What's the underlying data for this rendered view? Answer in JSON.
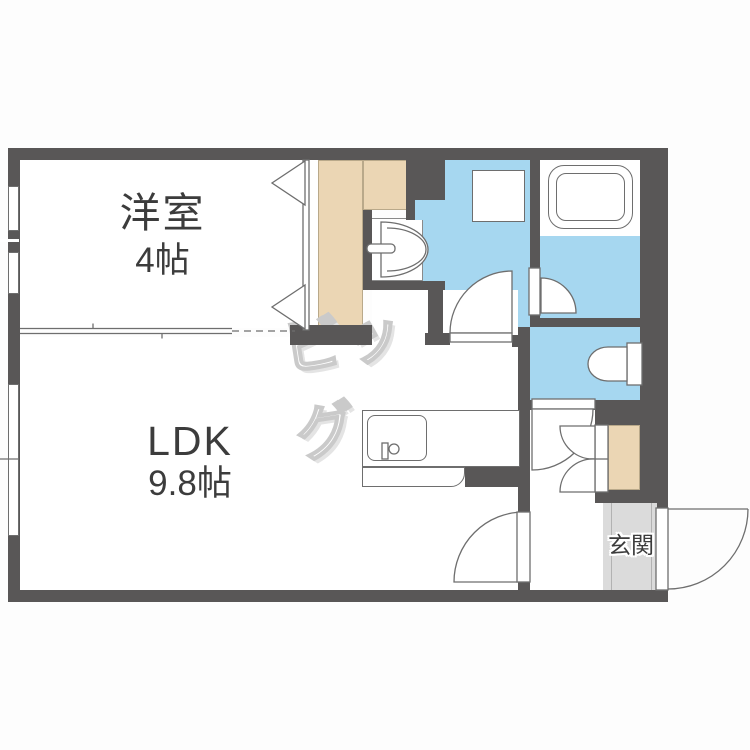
{
  "plan": {
    "watermark": "ビッグ",
    "rooms": {
      "western": {
        "name": "洋室",
        "size": "4帖"
      },
      "ldk": {
        "name": "LDK",
        "size": "9.8帖"
      },
      "entrance": {
        "name": "玄関"
      }
    }
  },
  "colors": {
    "wall": "#595757",
    "water_area": "#A6D7F0",
    "closet": "#EBD6B4",
    "entrance_floor": "#DBDBDB",
    "fixture_line": "#6E6E6E",
    "room_text": "#3C3C3C",
    "watermark_gray": "#CACACA"
  }
}
